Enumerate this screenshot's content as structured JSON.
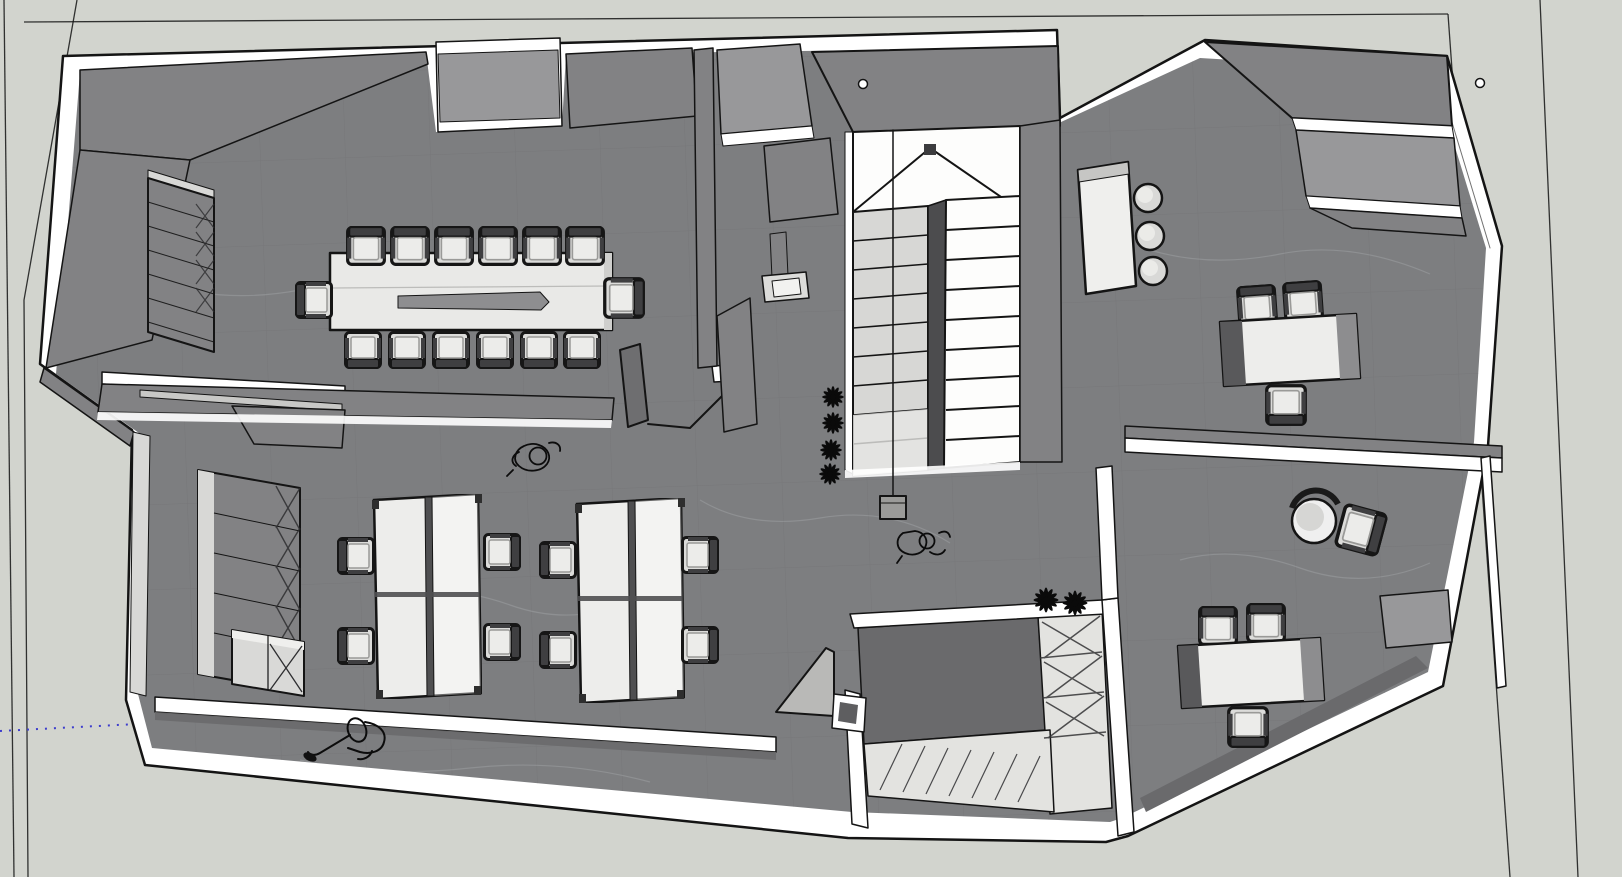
{
  "colors": {
    "background": "#d2d4ce",
    "edge": "#141414",
    "axis_blue": "#3d3dcc",
    "wall_white": "#ffffff",
    "wall_gray": "#828284",
    "wall_mid": "#98989a",
    "wall_dark": "#6a6a6c",
    "wall_face_light": "#d8d8d6",
    "floor": "#7d7e80",
    "floor_tile_line": "#6e6f71",
    "floor_vein": "#b0b2b4",
    "shelf_light": "#e3e3e0",
    "table_top": "#e9e9e7",
    "desk_top": "#ededeb",
    "divider_dark": "#4f4f51",
    "groove": "#8e8e90",
    "chair_seat": "#dcdcda",
    "chair_frame": "#161616",
    "chair_back": "#3f3f41",
    "tread_gray": "#d7d7d5",
    "tread_white": "#fdfdfc",
    "stringer_dark": "#4c4c4e",
    "stool": "#d9d9d7",
    "counter_white": "#efefed",
    "lamp": "#9b9b99",
    "person": "#0c0c0c",
    "plant": "#0a0a0a"
  },
  "scene": {
    "object_counts": {
      "conference_chairs": 14,
      "conference_tables": 1,
      "workstation_clusters": 2,
      "workstation_chairs": 8,
      "storage_cabinets": 2,
      "wall_shelves": 2,
      "bar_counters": 1,
      "bar_stools": 3,
      "office_desks": 2,
      "office_chairs": 6,
      "lounge_chairs": 2,
      "staircase_flights": 2,
      "stair_landings": 1,
      "pendant_lights": 1,
      "open_doors": 2,
      "plants": 6,
      "people": 3,
      "column_markers": 2
    }
  }
}
